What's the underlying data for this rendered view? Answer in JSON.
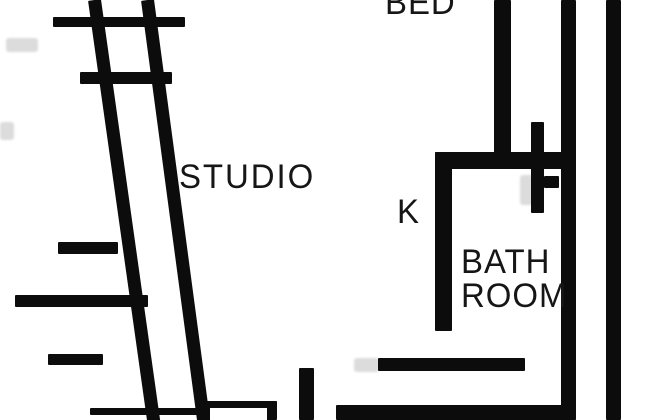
{
  "title": "Studio apartment floor plan",
  "colors": {
    "background": "#ffffff",
    "wall": "#0c0c0c",
    "label_text": "#161616",
    "shadow": "rgba(40,40,40,0.16)"
  },
  "labels": {
    "bed": "BED",
    "studio": "STUDIO",
    "kitchen": "K",
    "bathroom_line1": "BATH",
    "bathroom_line2": "ROOM"
  },
  "walls": [
    {
      "name": "window-wall-top-ledge",
      "x": 53,
      "y": 17,
      "w": 132,
      "h": 10
    },
    {
      "name": "window-wall-outer-diagonal",
      "x": 88,
      "y": 0,
      "w": 13,
      "h": 428,
      "rotate": -8
    },
    {
      "name": "window-wall-inner-diagonal",
      "x": 141,
      "y": 0,
      "w": 13,
      "h": 428,
      "rotate": -7.6
    },
    {
      "name": "window-mullion-1",
      "x": 80,
      "y": 72,
      "w": 92,
      "h": 12
    },
    {
      "name": "window-mullion-2",
      "x": 58,
      "y": 242,
      "w": 60,
      "h": 12
    },
    {
      "name": "window-wall-mid-ledge",
      "x": 15,
      "y": 295,
      "w": 133,
      "h": 12
    },
    {
      "name": "window-mullion-3",
      "x": 48,
      "y": 354,
      "w": 55,
      "h": 11
    },
    {
      "name": "bed-partition-wall",
      "x": 494,
      "y": 0,
      "w": 17,
      "h": 168
    },
    {
      "name": "right-inner-wall",
      "x": 561,
      "y": 0,
      "w": 15,
      "h": 420
    },
    {
      "name": "right-outer-wall",
      "x": 606,
      "y": 0,
      "w": 15,
      "h": 420
    },
    {
      "name": "bathroom-top-wall",
      "x": 435,
      "y": 152,
      "w": 141,
      "h": 17
    },
    {
      "name": "bathroom-left-wall",
      "x": 435,
      "y": 152,
      "w": 17,
      "h": 179
    },
    {
      "name": "plumbing-stub",
      "x": 531,
      "y": 122,
      "w": 13,
      "h": 91
    },
    {
      "name": "plumbing-tick",
      "x": 544,
      "y": 176,
      "w": 15,
      "h": 12
    },
    {
      "name": "bathroom-bottom-wall",
      "x": 378,
      "y": 358,
      "w": 147,
      "h": 13
    },
    {
      "name": "bottom-wall-left",
      "x": 90,
      "y": 408,
      "w": 112,
      "h": 7
    },
    {
      "name": "bottom-door-marker",
      "x": 200,
      "y": 401,
      "w": 77,
      "h": 19,
      "hollow": true
    },
    {
      "name": "entry-stub",
      "x": 299,
      "y": 368,
      "w": 15,
      "h": 52
    },
    {
      "name": "bottom-wall-right",
      "x": 336,
      "y": 405,
      "w": 240,
      "h": 15
    }
  ],
  "smudges": [
    {
      "name": "door-swing-shadow",
      "x": 520,
      "y": 175,
      "w": 13,
      "h": 30
    },
    {
      "name": "wall-shadow-bath",
      "x": 354,
      "y": 358,
      "w": 25,
      "h": 14
    },
    {
      "name": "edge-artifact-top",
      "x": 6,
      "y": 38,
      "w": 32,
      "h": 14
    },
    {
      "name": "edge-artifact-left",
      "x": 0,
      "y": 122,
      "w": 14,
      "h": 18
    }
  ]
}
